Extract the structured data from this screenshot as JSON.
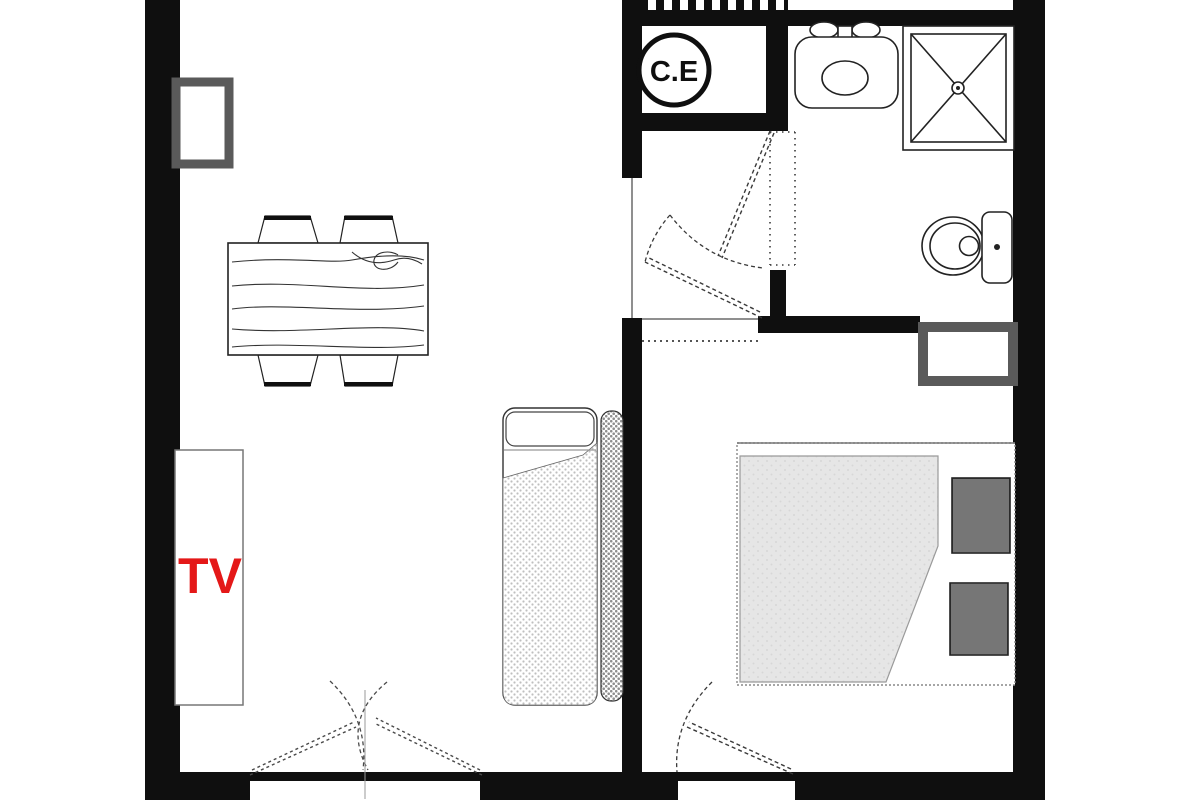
{
  "labels": {
    "water_heater": "C.E",
    "tv": "TV"
  },
  "colors": {
    "wall": "#0f0f0f",
    "thin_line": "#3a3a3a",
    "soft_line": "#8a8a8a",
    "window_frame": "#5a5a5a",
    "tv_label": "#e41818",
    "blanket_fill": "#e6e6e6",
    "mattress_dot": "#bfbfbf",
    "bolster_dot": "#8f8f8f",
    "pillow_grid": "#2e2e2e",
    "background": "#ffffff"
  },
  "fixtures": {
    "water_heater_closet": "water-heater-circle",
    "vent_grille": "vent-grille-icon",
    "sink": "sink-icon",
    "shower": "shower-icon",
    "toilet": "toilet-icon",
    "dining_table": "dining-table-icon",
    "chairs": "chair-icon",
    "tv_stand": "tv-stand",
    "daybed": "daybed-icon",
    "double_bed": "double-bed-icon",
    "windows": "window-icon",
    "doors": "door-swing-icon"
  }
}
